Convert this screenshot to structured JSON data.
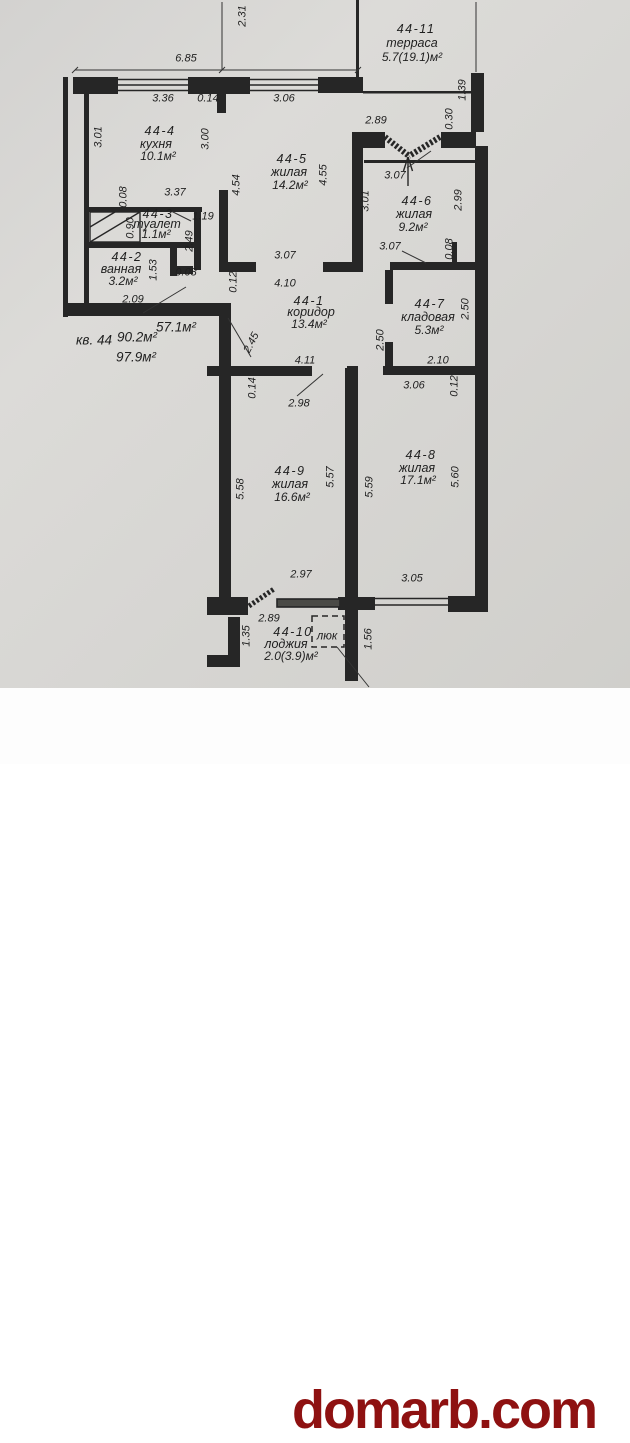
{
  "plan": {
    "rooms": [
      {
        "id": "44-1",
        "name": "коридор",
        "area": "13.4м²"
      },
      {
        "id": "44-2",
        "name": "ванная",
        "area": "3.2м²"
      },
      {
        "id": "44-3",
        "name": "туалет",
        "area": "1.1м²"
      },
      {
        "id": "44-4",
        "name": "кухня",
        "area": "10.1м²"
      },
      {
        "id": "44-5",
        "name": "жилая",
        "area": "14.2м²"
      },
      {
        "id": "44-6",
        "name": "жилая",
        "area": "9.2м²"
      },
      {
        "id": "44-7",
        "name": "кладовая",
        "area": "5.3м²"
      },
      {
        "id": "44-8",
        "name": "жилая",
        "area": "17.1м²"
      },
      {
        "id": "44-9",
        "name": "жилая",
        "area": "16.6м²"
      },
      {
        "id": "44-10",
        "name": "лоджия",
        "area": "2.0(3.9)м²"
      },
      {
        "id": "44-11",
        "name": "терраса",
        "area": "5.7(19.1)м²"
      }
    ],
    "apartment_summary": {
      "living_area": "57.1м²",
      "unit": "кв. 44",
      "total_area": "90.2м²",
      "total_with_balconies": "97.9м²"
    },
    "texts": [
      {
        "t": "44-11",
        "x": 416,
        "y": 29,
        "k": "room-id"
      },
      {
        "t": "терраса",
        "x": 412,
        "y": 43,
        "k": "room-name"
      },
      {
        "t": "5.7(19.1)м²",
        "x": 412,
        "y": 57,
        "k": "room-area"
      },
      {
        "t": "2.31",
        "x": 243,
        "y": 16,
        "r": -90
      },
      {
        "t": "6.85",
        "x": 186,
        "y": 59
      },
      {
        "t": "3.36",
        "x": 163,
        "y": 99
      },
      {
        "t": "0.14",
        "x": 208,
        "y": 99
      },
      {
        "t": "3.06",
        "x": 284,
        "y": 99
      },
      {
        "t": "2.89",
        "x": 376,
        "y": 121
      },
      {
        "t": "0.30",
        "x": 450,
        "y": 119,
        "r": -90
      },
      {
        "t": "1.39",
        "x": 463,
        "y": 90,
        "r": -90
      },
      {
        "t": "3.01",
        "x": 99,
        "y": 137,
        "r": -90
      },
      {
        "t": "44-4",
        "x": 160,
        "y": 131,
        "k": "room-id"
      },
      {
        "t": "кухня",
        "x": 156,
        "y": 144,
        "k": "room-name"
      },
      {
        "t": "10.1м²",
        "x": 158,
        "y": 156,
        "k": "room-area"
      },
      {
        "t": "3.00",
        "x": 206,
        "y": 139,
        "r": -90
      },
      {
        "t": "44-5",
        "x": 292,
        "y": 159,
        "k": "room-id"
      },
      {
        "t": "жилая",
        "x": 289,
        "y": 172,
        "k": "room-name"
      },
      {
        "t": "14.2м²",
        "x": 290,
        "y": 185,
        "k": "room-area"
      },
      {
        "t": "4.54",
        "x": 237,
        "y": 185,
        "r": -90
      },
      {
        "t": "4.55",
        "x": 324,
        "y": 175,
        "r": -90
      },
      {
        "t": "3.07",
        "x": 285,
        "y": 256
      },
      {
        "t": "4.10",
        "x": 285,
        "y": 284
      },
      {
        "t": "0.12",
        "x": 234,
        "y": 282,
        "r": -90
      },
      {
        "t": "0.08",
        "x": 124,
        "y": 197,
        "r": -90
      },
      {
        "t": "3.37",
        "x": 175,
        "y": 193
      },
      {
        "t": "44-3",
        "x": 158,
        "y": 214,
        "k": "room-id"
      },
      {
        "t": "туалет",
        "x": 157,
        "y": 224,
        "k": "room-name"
      },
      {
        "t": "1.1м²",
        "x": 156,
        "y": 234,
        "k": "room-area"
      },
      {
        "t": "1.19",
        "x": 203,
        "y": 217
      },
      {
        "t": "0.90",
        "x": 131,
        "y": 228,
        "r": -90
      },
      {
        "t": "2.49",
        "x": 190,
        "y": 241,
        "r": -90
      },
      {
        "t": "44-2",
        "x": 127,
        "y": 257,
        "k": "room-id"
      },
      {
        "t": "ванная",
        "x": 121,
        "y": 269,
        "k": "room-name"
      },
      {
        "t": "3.2м²",
        "x": 123,
        "y": 281,
        "k": "room-area"
      },
      {
        "t": "1.53",
        "x": 154,
        "y": 270,
        "r": -90
      },
      {
        "t": "0.08",
        "x": 186,
        "y": 273
      },
      {
        "t": "2.09",
        "x": 133,
        "y": 300
      },
      {
        "t": "3.07",
        "x": 395,
        "y": 176
      },
      {
        "t": "3.01",
        "x": 366,
        "y": 201,
        "r": -90
      },
      {
        "t": "44-6",
        "x": 417,
        "y": 201,
        "k": "room-id"
      },
      {
        "t": "жилая",
        "x": 414,
        "y": 214,
        "k": "room-name"
      },
      {
        "t": "9.2м²",
        "x": 413,
        "y": 227,
        "k": "room-area"
      },
      {
        "t": "2.99",
        "x": 459,
        "y": 200,
        "r": -90
      },
      {
        "t": "3.07",
        "x": 390,
        "y": 247
      },
      {
        "t": "0.08",
        "x": 450,
        "y": 249,
        "r": -90
      },
      {
        "t": "44-1",
        "x": 309,
        "y": 301,
        "k": "room-id"
      },
      {
        "t": "коридор",
        "x": 311,
        "y": 312,
        "k": "room-name"
      },
      {
        "t": "13.4м²",
        "x": 309,
        "y": 324,
        "k": "room-area"
      },
      {
        "t": "57.1м²",
        "x": 176,
        "y": 327,
        "k": "summary"
      },
      {
        "t": "кв. 44",
        "x": 94,
        "y": 340,
        "k": "summary"
      },
      {
        "t": "90.2м²",
        "x": 137,
        "y": 337,
        "k": "summary"
      },
      {
        "t": "97.9м²",
        "x": 136,
        "y": 357,
        "k": "summary"
      },
      {
        "t": "2.45",
        "x": 252,
        "y": 343,
        "r": -63
      },
      {
        "t": "44-7",
        "x": 430,
        "y": 304,
        "k": "room-id"
      },
      {
        "t": "кладовая",
        "x": 428,
        "y": 317,
        "k": "room-name"
      },
      {
        "t": "5.3м²",
        "x": 429,
        "y": 330,
        "k": "room-area"
      },
      {
        "t": "2.50",
        "x": 466,
        "y": 309,
        "r": -90
      },
      {
        "t": "2.50",
        "x": 381,
        "y": 340,
        "r": -90
      },
      {
        "t": "2.10",
        "x": 438,
        "y": 361
      },
      {
        "t": "3.06",
        "x": 414,
        "y": 386
      },
      {
        "t": "0.12",
        "x": 455,
        "y": 386,
        "r": -90
      },
      {
        "t": "4.11",
        "x": 305,
        "y": 361
      },
      {
        "t": "0.14",
        "x": 253,
        "y": 388,
        "r": -90
      },
      {
        "t": "2.98",
        "x": 299,
        "y": 404
      },
      {
        "t": "44-9",
        "x": 290,
        "y": 471,
        "k": "room-id"
      },
      {
        "t": "жилая",
        "x": 290,
        "y": 484,
        "k": "room-name"
      },
      {
        "t": "16.6м²",
        "x": 292,
        "y": 497,
        "k": "room-area"
      },
      {
        "t": "5.58",
        "x": 241,
        "y": 489,
        "r": -90
      },
      {
        "t": "5.57",
        "x": 331,
        "y": 477,
        "r": -90
      },
      {
        "t": "5.59",
        "x": 370,
        "y": 487,
        "r": -90
      },
      {
        "t": "2.97",
        "x": 301,
        "y": 575
      },
      {
        "t": "44-8",
        "x": 421,
        "y": 455,
        "k": "room-id"
      },
      {
        "t": "жилая",
        "x": 417,
        "y": 468,
        "k": "room-name"
      },
      {
        "t": "17.1м²",
        "x": 418,
        "y": 480,
        "k": "room-area"
      },
      {
        "t": "5.60",
        "x": 456,
        "y": 477,
        "r": -90
      },
      {
        "t": "3.05",
        "x": 412,
        "y": 579
      },
      {
        "t": "2.89",
        "x": 269,
        "y": 619
      },
      {
        "t": "1.35",
        "x": 247,
        "y": 636,
        "r": -90
      },
      {
        "t": "44-10",
        "x": 293,
        "y": 632,
        "k": "room-id"
      },
      {
        "t": "лоджия",
        "x": 286,
        "y": 644,
        "k": "room-name"
      },
      {
        "t": "2.0(3.9)м²",
        "x": 291,
        "y": 656,
        "k": "room-area"
      },
      {
        "t": "люк",
        "x": 327,
        "y": 637,
        "k": "hatch"
      },
      {
        "t": "1.56",
        "x": 369,
        "y": 639,
        "r": -90
      }
    ]
  },
  "watermark": {
    "text": "domarb.com",
    "color": "#8e1111"
  },
  "colors": {
    "paper": "#d6d5d2",
    "line": "#262626",
    "watermark_band": "#fdfdfd"
  }
}
